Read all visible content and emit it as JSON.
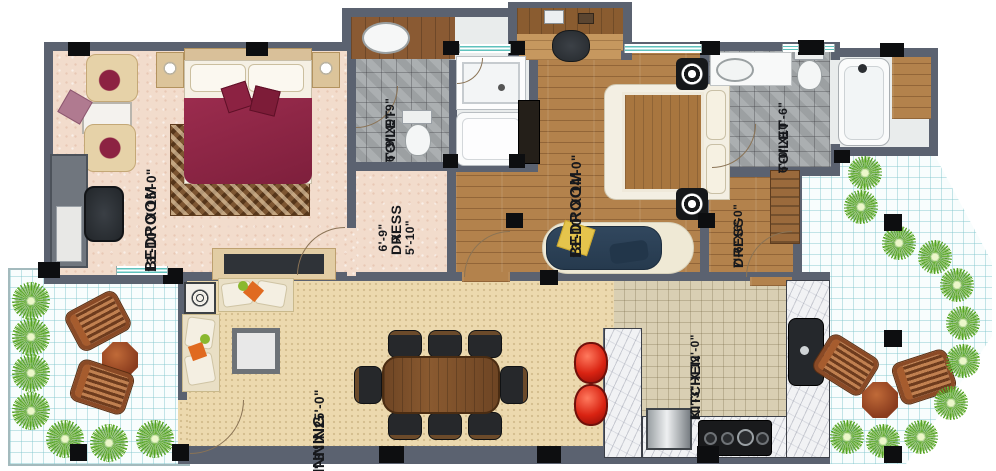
{
  "rooms": [
    {
      "name": "BEDROOM",
      "dims": "13'-10\" X 15'-0\""
    },
    {
      "name": "TOILET",
      "dims": "6'-9\"X9'-9\""
    },
    {
      "name": "DRESS",
      "dims": "6'-9\"\nX\n5'-10\""
    },
    {
      "name": "BEDROOM",
      "dims": "13'-10\" X 14'-0\""
    },
    {
      "name": "TOILET",
      "dims": "6'-0\"X10'-6\""
    },
    {
      "name": "DRESS",
      "dims": "7'-6\"X6'-0\""
    },
    {
      "name": "DINNING",
      "dims": "10'-3\" X 25'-0\""
    },
    {
      "name": "KITCHEN",
      "dims": "10'-3\" X 12'-0\""
    }
  ],
  "colors": {
    "wall": "#5b6270",
    "column": "#0d0e10",
    "window_glass": "#5fc2bd",
    "bedroom1_floor": "#f2dccc",
    "bedroom2_floor": "#b3824c",
    "toilet_floor": "#a6aaac",
    "dining_floor": "#ecd9ae",
    "kitchen_floor": "#d9cfb3",
    "terrace_floor": "#f8fdfd",
    "bed_blanket": "#8e2746",
    "sofa_navy": "#2e4156",
    "pillow_yellow": "#e5c44c",
    "stool_red": "#d92312",
    "plant_green": "#53a028",
    "marble": "#f1f2f4",
    "lounge_wood": "#a65c2e"
  }
}
